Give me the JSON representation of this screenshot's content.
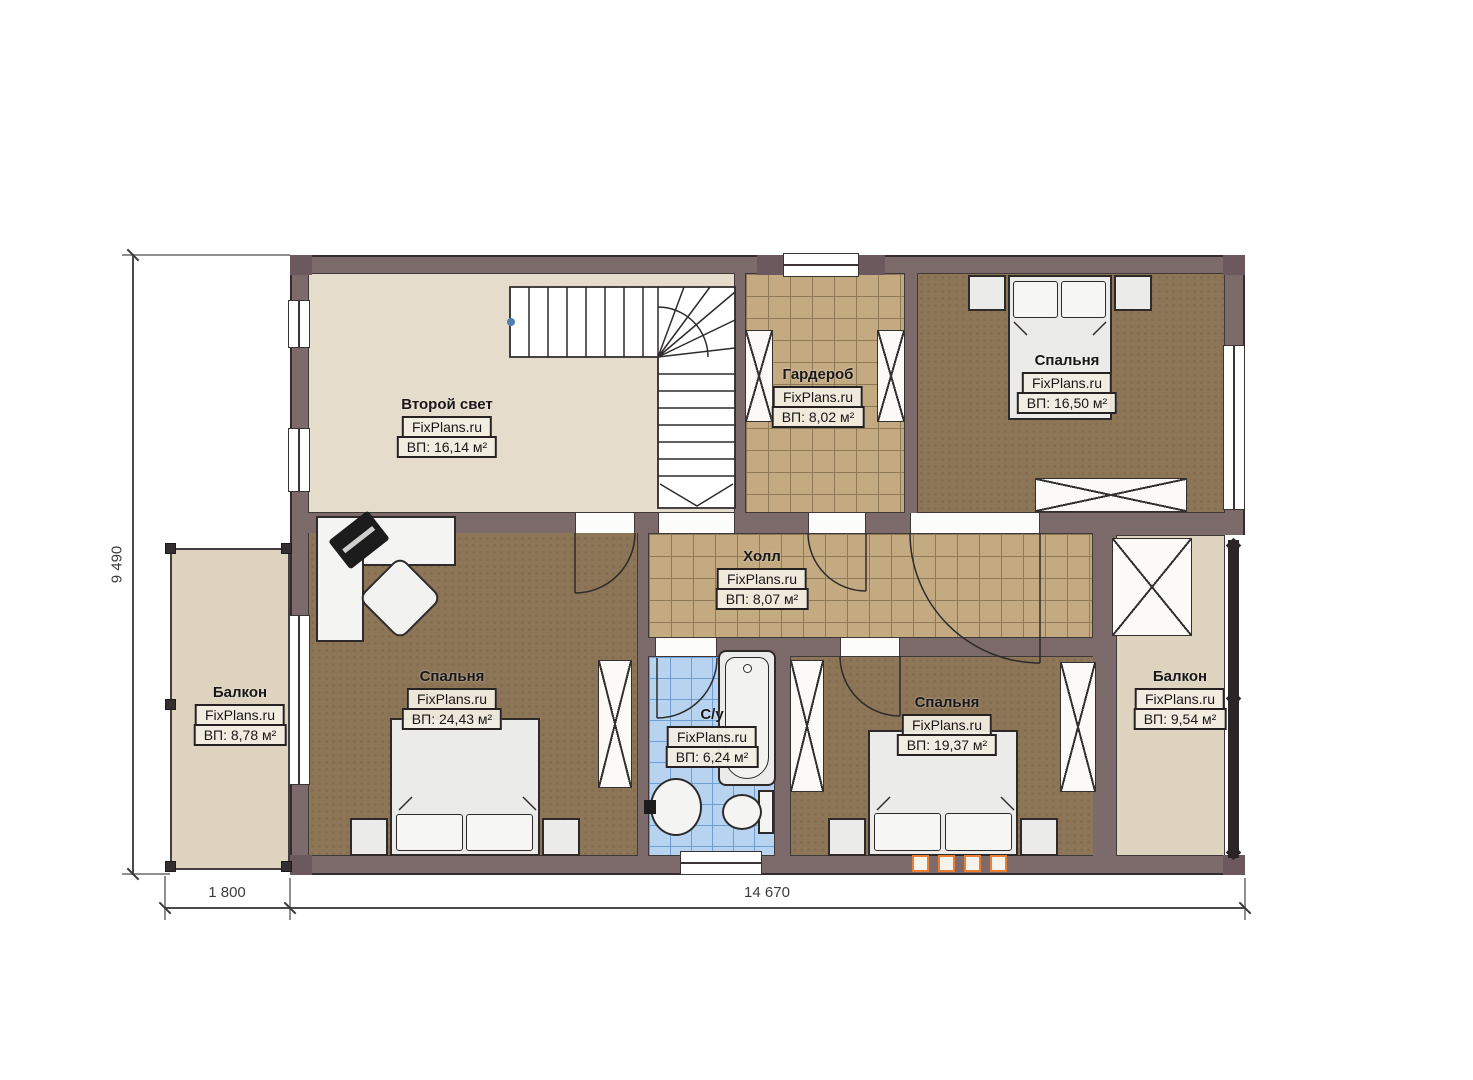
{
  "rooms": [
    {
      "key": "second-light",
      "name": "Второй свет",
      "brand": "FixPlans.ru",
      "area": "ВП: 16,14 м²"
    },
    {
      "key": "wardrobe",
      "name": "Гардероб",
      "brand": "FixPlans.ru",
      "area": "ВП: 8,02 м²"
    },
    {
      "key": "bedroom-top-right",
      "name": "Спальня",
      "brand": "FixPlans.ru",
      "area": "ВП: 16,50 м²"
    },
    {
      "key": "hall",
      "name": "Холл",
      "brand": "FixPlans.ru",
      "area": "ВП: 8,07 м²"
    },
    {
      "key": "balcony-left",
      "name": "Балкон",
      "brand": "FixPlans.ru",
      "area": "ВП: 8,78 м²"
    },
    {
      "key": "bedroom-left",
      "name": "Спальня",
      "brand": "FixPlans.ru",
      "area": "ВП: 24,43 м²"
    },
    {
      "key": "bathroom",
      "name": "С/у",
      "brand": "FixPlans.ru",
      "area": "ВП: 6,24 м²"
    },
    {
      "key": "bedroom-right",
      "name": "Спальня",
      "brand": "FixPlans.ru",
      "area": "ВП: 19,37 м²"
    },
    {
      "key": "balcony-right",
      "name": "Балкон",
      "brand": "FixPlans.ru",
      "area": "ВП: 9,54 м²"
    }
  ],
  "dimensions": {
    "left_height": "9 490",
    "bottom_balcony": "1 800",
    "bottom_main": "14 670"
  },
  "colors": {
    "wall": "#7d6a6b",
    "floor_beige": "#e6dccb",
    "floor_balcony": "#ddd3bf",
    "floor_bedroom": "#8d7557",
    "floor_tile": "#c3aa80",
    "floor_bathroom": "#b7d3f0",
    "outline": "#332d2f",
    "radiator_accent": "#e87f35"
  }
}
